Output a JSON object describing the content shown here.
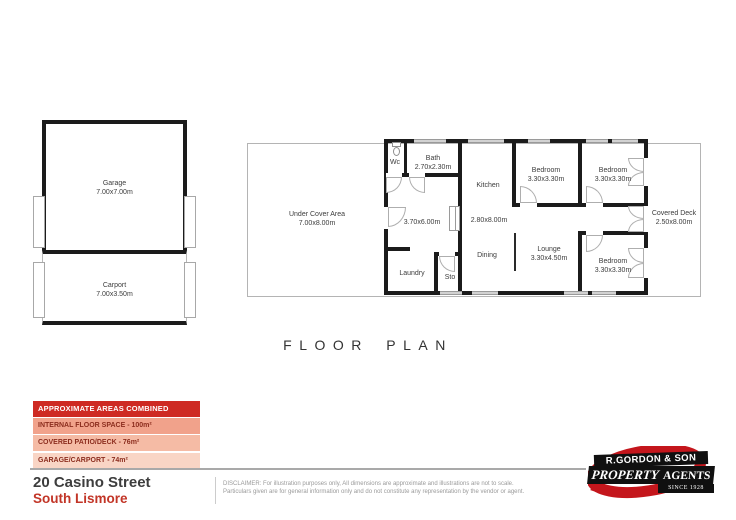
{
  "title": "FLOOR PLAN",
  "garage_block": {
    "garage": {
      "name": "Garage",
      "dims": "7.00x7.00m"
    },
    "carport": {
      "name": "Carport",
      "dims": "7.00x3.50m"
    }
  },
  "plan": {
    "under_cover": {
      "name": "Under Cover Area",
      "dims": "7.00x8.00m"
    },
    "wc": {
      "name": "Wc"
    },
    "bath": {
      "name": "Bath",
      "dims": "2.70x2.30m"
    },
    "room_370": {
      "dims": "3.70x6.00m"
    },
    "laundry": {
      "name": "Laundry"
    },
    "sto": {
      "name": "Sto"
    },
    "kitchen": {
      "name": "Kitchen"
    },
    "hall": {
      "dims": "2.80x8.00m"
    },
    "dining": {
      "name": "Dining"
    },
    "bedroom_top_mid": {
      "name": "Bedroom",
      "dims": "3.30x3.30m"
    },
    "bedroom_top_right": {
      "name": "Bedroom",
      "dims": "3.30x3.30m"
    },
    "lounge": {
      "name": "Lounge",
      "dims": "3.30x4.50m"
    },
    "bedroom_bottom_right": {
      "name": "Bedroom",
      "dims": "3.30x3.30m"
    },
    "covered_deck": {
      "name": "Covered Deck",
      "dims": "2.50x8.00m"
    }
  },
  "legend": {
    "header": "APPROXIMATE AREAS COMBINED",
    "rows": [
      {
        "label": "INTERNAL FLOOR SPACE - 100m²"
      },
      {
        "label": "COVERED PATIO/DECK - 76m²"
      },
      {
        "label": "GARAGE/CARPORT - 74m²"
      }
    ],
    "colors": {
      "header_bg": "#ce2a23",
      "row1_bg": "#f1a28b",
      "row2_bg": "#f5bba5",
      "row3_bg": "#f9d5c5",
      "row_text": "#8c2d1e"
    }
  },
  "footer": {
    "address_line1": "20 Casino Street",
    "address_line2": "South Lismore",
    "address_accent": "#c23527",
    "disclaimer_line1": "DISCLAIMER: For illustration purposes only, All dimensions are approximate and illustrations are not to scale.",
    "disclaimer_line2": "Particulars given are for general information only and do not constitute any representation by the vendor or agent."
  },
  "logo": {
    "line1": "R.GORDON & SON",
    "line2_left": "PROPERTY",
    "line2_right": "AGENTS",
    "line3": "SINCE 1928",
    "red": "#c4161c"
  }
}
